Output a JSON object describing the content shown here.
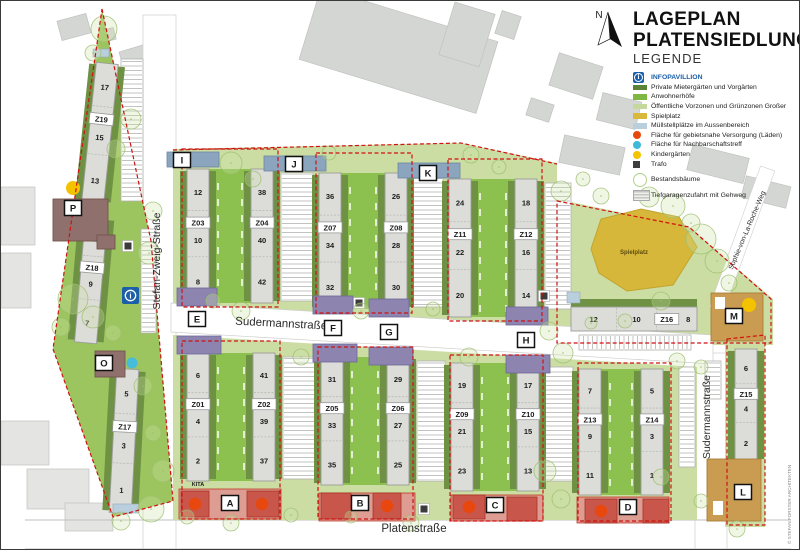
{
  "title": {
    "line1": "LAGEPLAN",
    "line2": "PLATENSIEDLUNG"
  },
  "legend": {
    "heading": "LEGENDE",
    "info_item": {
      "label": "INFOPAVILLION",
      "color": "#1a5fa8"
    },
    "items": [
      {
        "type": "swatch",
        "color": "#5c8236",
        "label": "Private Mietergärten und Vorgärten"
      },
      {
        "type": "swatch",
        "color": "#7eb843",
        "label": "Anwohnerhöfe"
      },
      {
        "type": "swatch",
        "color": "#c4d89c",
        "label": "Öffentliche Vorzonen und Grünzonen Großer"
      },
      {
        "type": "swatch",
        "color": "#d9b93c",
        "label": "Spielplatz"
      },
      {
        "type": "swatch",
        "color": "#b9cfdd",
        "label": "Müllstellplätze im Aussenbereich"
      },
      {
        "type": "circle",
        "color": "#e8470e",
        "label": "Fläche für gebietsnahe Versorgung (Läden)"
      },
      {
        "type": "circle",
        "color": "#3fb9d8",
        "label": "Fläche für Nachbarschaftstreff"
      },
      {
        "type": "circle",
        "color": "#f4c400",
        "label": "Kindergärten"
      },
      {
        "type": "square",
        "color": "#3d3d3d",
        "label": "Trafo"
      },
      {
        "type": "tree",
        "color": "#b7d58e",
        "label": "Bestandsbäume",
        "gap": true
      },
      {
        "type": "ramp",
        "color": "#c9c9c9",
        "label": "Tiefgaragenzufahrt mit Gehweg",
        "gap": true
      }
    ]
  },
  "north": {
    "label": "N"
  },
  "copyright": "© STEFAN FORSTER ARCHITEKTEN",
  "map": {
    "colors": {
      "light_green": "#cbdda2",
      "yard_green": "#8cc04f",
      "dark_green": "#6e9143",
      "triangle_green": "#9cc45f",
      "building": "#dcdcd8",
      "building_stroke": "#9c9e9a",
      "blue_head": "#8ba5bf",
      "purple_head": "#8d85b0",
      "tan": "#c99c52",
      "mauve": "#8f706c",
      "commercial_strip": "#dd9d92",
      "commercial_block": "#c8564a",
      "red": "#d01111",
      "spielplatz": "#d7b739",
      "muell_blue": "#b9cfdd",
      "cyan": "#45bcd9",
      "yellow": "#f3c300",
      "trafo": "#3b3b3b",
      "context": "#d4d6d3",
      "context_light": "#e4e5e3"
    },
    "street_labels": [
      {
        "name": "Stefan-Zweig-Straße",
        "x": 159,
        "y": 260,
        "rotate": -90,
        "size": 10.5
      },
      {
        "name": "Sudermannstraße",
        "x": 280,
        "y": 326,
        "rotate": 3,
        "size": 11.5
      },
      {
        "name": "Sudermannstraße",
        "x": 709,
        "y": 416,
        "rotate": -90,
        "size": 10.5
      },
      {
        "name": "Platenstraße",
        "x": 413,
        "y": 531,
        "rotate": 0,
        "size": 11.5
      },
      {
        "name": "Sophie-von-La-Roche-Weg",
        "x": 748,
        "y": 230,
        "rotate": -67,
        "size": 7
      }
    ],
    "buildings": [
      {
        "z": "Z19",
        "nums": [
          "17",
          "15",
          "13"
        ],
        "x": 88,
        "y": 62,
        "w": 22,
        "h": 140,
        "tilt": 6
      },
      {
        "z": "Z18",
        "nums": [
          "11",
          "9",
          "7"
        ],
        "x": 79,
        "y": 216,
        "w": 22,
        "h": 126,
        "tilt": 5
      },
      {
        "z": "Z17",
        "nums": [
          "5",
          "3",
          "1"
        ],
        "x": 112,
        "y": 368,
        "w": 22,
        "h": 144,
        "tilt": 3
      },
      {
        "z": "Z03",
        "nums": [
          "12",
          "10",
          "8"
        ],
        "x": 186,
        "y": 168,
        "w": 22,
        "h": 134,
        "tilt": 0
      },
      {
        "z": "Z04",
        "nums": [
          "38",
          "40",
          "42"
        ],
        "x": 250,
        "y": 168,
        "w": 22,
        "h": 134,
        "tilt": 0
      },
      {
        "z": "Z07",
        "nums": [
          "36",
          "34",
          "32"
        ],
        "x": 318,
        "y": 172,
        "w": 22,
        "h": 136,
        "tilt": 0
      },
      {
        "z": "Z08",
        "nums": [
          "26",
          "28",
          "30"
        ],
        "x": 384,
        "y": 172,
        "w": 22,
        "h": 136,
        "tilt": 0
      },
      {
        "z": "Z11",
        "nums": [
          "24",
          "22",
          "20"
        ],
        "x": 448,
        "y": 178,
        "w": 22,
        "h": 138,
        "tilt": 0
      },
      {
        "z": "Z12",
        "nums": [
          "18",
          "16",
          "14"
        ],
        "x": 514,
        "y": 178,
        "w": 22,
        "h": 138,
        "tilt": 0
      },
      {
        "z": "Z01",
        "nums": [
          "6",
          "4",
          "2"
        ],
        "x": 186,
        "y": 352,
        "w": 22,
        "h": 128,
        "tilt": 0
      },
      {
        "z": "Z02",
        "nums": [
          "41",
          "39",
          "37"
        ],
        "x": 252,
        "y": 352,
        "w": 22,
        "h": 128,
        "tilt": 0
      },
      {
        "z": "Z05",
        "nums": [
          "31",
          "33",
          "35"
        ],
        "x": 320,
        "y": 356,
        "w": 22,
        "h": 128,
        "tilt": 0
      },
      {
        "z": "Z06",
        "nums": [
          "29",
          "27",
          "25"
        ],
        "x": 386,
        "y": 356,
        "w": 22,
        "h": 128,
        "tilt": 0
      },
      {
        "z": "Z09",
        "nums": [
          "19",
          "21",
          "23"
        ],
        "x": 450,
        "y": 362,
        "w": 22,
        "h": 128,
        "tilt": 0
      },
      {
        "z": "Z10",
        "nums": [
          "17",
          "15",
          "13"
        ],
        "x": 516,
        "y": 362,
        "w": 22,
        "h": 128,
        "tilt": 0
      },
      {
        "z": "Z13",
        "nums": [
          "7",
          "9",
          "11"
        ],
        "x": 578,
        "y": 368,
        "w": 22,
        "h": 126,
        "tilt": 0
      },
      {
        "z": "Z14",
        "nums": [
          "5",
          "3",
          "1"
        ],
        "x": 640,
        "y": 368,
        "w": 22,
        "h": 126,
        "tilt": 0
      },
      {
        "z": "Z15",
        "nums": [
          "6",
          "4",
          "2"
        ],
        "x": 734,
        "y": 348,
        "w": 22,
        "h": 112,
        "tilt": 0
      },
      {
        "z": "Z16",
        "nums": [
          "12",
          "10",
          "8"
        ],
        "x": 570,
        "y": 306,
        "w": 126,
        "h": 24,
        "tilt": 0,
        "horizontal": true
      }
    ],
    "yards": [
      {
        "label": "Hof 2",
        "x": 208,
        "y": 168,
        "w": 42,
        "h": 134,
        "lx": 230,
        "ly": 233
      },
      {
        "label": "Hof 4",
        "x": 340,
        "y": 172,
        "w": 44,
        "h": 136,
        "lx": 362,
        "ly": 238
      },
      {
        "label": "Hof 6",
        "x": 470,
        "y": 178,
        "w": 44,
        "h": 138,
        "lx": 492,
        "ly": 240
      },
      {
        "label": "Hof 1",
        "x": 208,
        "y": 352,
        "w": 44,
        "h": 128,
        "lx": 230,
        "ly": 399
      },
      {
        "label": "Hof 3",
        "x": 342,
        "y": 356,
        "w": 44,
        "h": 128,
        "lx": 364,
        "ly": 402
      },
      {
        "label": "Hof 5",
        "x": 472,
        "y": 362,
        "w": 44,
        "h": 128,
        "lx": 494,
        "ly": 412
      },
      {
        "label": "Hof 7",
        "x": 600,
        "y": 368,
        "w": 40,
        "h": 126,
        "lx": 620,
        "ly": 418
      }
    ],
    "markers": [
      {
        "letter": "A",
        "x": 229,
        "y": 502
      },
      {
        "letter": "B",
        "x": 359,
        "y": 502
      },
      {
        "letter": "C",
        "x": 494,
        "y": 504
      },
      {
        "letter": "D",
        "x": 627,
        "y": 506
      },
      {
        "letter": "E",
        "x": 196,
        "y": 318
      },
      {
        "letter": "F",
        "x": 332,
        "y": 327
      },
      {
        "letter": "G",
        "x": 388,
        "y": 331
      },
      {
        "letter": "H",
        "x": 525,
        "y": 339
      },
      {
        "letter": "I",
        "x": 181,
        "y": 159
      },
      {
        "letter": "J",
        "x": 293,
        "y": 163
      },
      {
        "letter": "K",
        "x": 427,
        "y": 172
      },
      {
        "letter": "L",
        "x": 742,
        "y": 491
      },
      {
        "letter": "M",
        "x": 733,
        "y": 315
      },
      {
        "letter": "O",
        "x": 103,
        "y": 362
      },
      {
        "letter": "P",
        "x": 72,
        "y": 207
      }
    ],
    "kita": {
      "label": "KITA",
      "x": 197,
      "y": 485
    },
    "spielplatz_label": {
      "label": "Spielplatz",
      "x": 633,
      "y": 253
    },
    "context": [
      [
        58,
        16,
        30,
        20,
        -15,
        0
      ],
      [
        100,
        28,
        14,
        12,
        -15,
        0
      ],
      [
        122,
        44,
        44,
        34,
        -17,
        0
      ],
      [
        94,
        96,
        16,
        13,
        -17,
        0
      ],
      [
        305,
        12,
        185,
        75,
        17,
        0
      ],
      [
        445,
        6,
        42,
        55,
        17,
        0
      ],
      [
        497,
        12,
        20,
        24,
        18,
        0
      ],
      [
        552,
        58,
        46,
        34,
        18,
        0
      ],
      [
        527,
        100,
        24,
        18,
        18,
        0
      ],
      [
        598,
        96,
        40,
        28,
        14,
        0
      ],
      [
        560,
        140,
        62,
        28,
        12,
        0
      ],
      [
        688,
        150,
        58,
        26,
        14,
        0
      ],
      [
        742,
        180,
        46,
        22,
        14,
        0
      ],
      [
        0,
        186,
        34,
        58,
        0,
        1
      ],
      [
        0,
        252,
        30,
        55,
        0,
        1
      ],
      [
        0,
        420,
        48,
        44,
        0,
        1
      ],
      [
        26,
        468,
        62,
        40,
        0,
        1
      ],
      [
        64,
        502,
        48,
        28,
        0,
        1
      ],
      [
        736,
        552,
        36,
        12,
        0,
        1
      ]
    ],
    "parking_v": [
      [
        280,
        172,
        32,
        128
      ],
      [
        412,
        176,
        30,
        130
      ],
      [
        544,
        182,
        26,
        126
      ],
      [
        282,
        356,
        32,
        122
      ],
      [
        416,
        360,
        28,
        120
      ],
      [
        544,
        366,
        28,
        114
      ],
      [
        678,
        366,
        16,
        100
      ],
      [
        704,
        360,
        16,
        38
      ],
      [
        140,
        228,
        15,
        104
      ],
      [
        120,
        58,
        22,
        142
      ]
    ],
    "parking_h": [
      [
        578,
        334,
        112,
        15
      ]
    ],
    "blue_heads": [
      [
        166,
        151,
        52,
        15
      ],
      [
        263,
        155,
        62,
        15
      ],
      [
        397,
        162,
        62,
        15
      ]
    ],
    "purple_heads": [
      [
        176,
        287,
        40,
        18
      ],
      [
        176,
        335,
        44,
        18
      ],
      [
        312,
        295,
        40,
        18
      ],
      [
        312,
        343,
        44,
        18
      ],
      [
        368,
        298,
        40,
        18
      ],
      [
        368,
        346,
        44,
        18
      ],
      [
        505,
        306,
        42,
        18
      ],
      [
        505,
        354,
        44,
        18
      ]
    ],
    "tan_buildings": [
      [
        710,
        292,
        52,
        48
      ],
      [
        706,
        458,
        54,
        62
      ]
    ],
    "tan_notches": [
      [
        714,
        296,
        10,
        12
      ],
      [
        712,
        500,
        10,
        14
      ]
    ],
    "mauve_buildings": [
      [
        52,
        198,
        55,
        42
      ],
      [
        96,
        234,
        18,
        14
      ],
      [
        94,
        350,
        30,
        26
      ]
    ],
    "commercial_strips": [
      [
        178,
        488,
        102,
        30
      ],
      [
        318,
        492,
        96,
        28
      ],
      [
        450,
        494,
        92,
        26
      ],
      [
        576,
        496,
        92,
        26
      ]
    ],
    "commercial_blocks": [
      [
        180,
        490,
        28,
        26
      ],
      [
        246,
        490,
        32,
        26
      ],
      [
        320,
        492,
        30,
        26
      ],
      [
        372,
        492,
        28,
        26
      ],
      [
        452,
        494,
        32,
        24
      ],
      [
        506,
        496,
        30,
        24
      ],
      [
        584,
        498,
        32,
        24
      ],
      [
        642,
        498,
        26,
        24
      ]
    ],
    "red_circles": [
      [
        194,
        503
      ],
      [
        261,
        503
      ],
      [
        386,
        505
      ],
      [
        468,
        506
      ],
      [
        600,
        510
      ]
    ],
    "dots": {
      "info": {
        "x": 121,
        "y": 286
      },
      "cyan": [
        [
          131,
          362
        ]
      ],
      "yellow": [
        [
          72,
          187
        ],
        [
          748,
          304
        ]
      ],
      "trafo": [
        [
          127,
          245
        ],
        [
          358,
          302
        ],
        [
          543,
          295
        ],
        [
          423,
          508
        ]
      ],
      "muell": [
        [
          92,
          48,
          16,
          8
        ],
        [
          112,
          503,
          26,
          9
        ],
        [
          566,
          291,
          13,
          11
        ]
      ]
    },
    "trees": [
      [
        103,
        28,
        13
      ],
      [
        92,
        52,
        8
      ],
      [
        130,
        118,
        10
      ],
      [
        115,
        148,
        9
      ],
      [
        152,
        210,
        9
      ],
      [
        148,
        252,
        11
      ],
      [
        72,
        298,
        15
      ],
      [
        92,
        316,
        11
      ],
      [
        112,
        332,
        8
      ],
      [
        60,
        326,
        9
      ],
      [
        142,
        385,
        9
      ],
      [
        152,
        432,
        8
      ],
      [
        162,
        470,
        11
      ],
      [
        150,
        508,
        13
      ],
      [
        120,
        520,
        9
      ],
      [
        186,
        516,
        7
      ],
      [
        230,
        162,
        11
      ],
      [
        252,
        178,
        8
      ],
      [
        212,
        300,
        7
      ],
      [
        240,
        310,
        9
      ],
      [
        328,
        152,
        7
      ],
      [
        360,
        310,
        8
      ],
      [
        300,
        356,
        8
      ],
      [
        470,
        154,
        8
      ],
      [
        498,
        166,
        7
      ],
      [
        432,
        308,
        7
      ],
      [
        468,
        356,
        9
      ],
      [
        560,
        190,
        10
      ],
      [
        582,
        178,
        7
      ],
      [
        600,
        195,
        8
      ],
      [
        648,
        196,
        10
      ],
      [
        672,
        205,
        12
      ],
      [
        700,
        238,
        15
      ],
      [
        716,
        260,
        12
      ],
      [
        690,
        222,
        9
      ],
      [
        728,
        282,
        8
      ],
      [
        660,
        300,
        9
      ],
      [
        624,
        320,
        7
      ],
      [
        590,
        322,
        6
      ],
      [
        548,
        330,
        9
      ],
      [
        562,
        352,
        10
      ],
      [
        544,
        470,
        11
      ],
      [
        560,
        498,
        9
      ],
      [
        660,
        476,
        8
      ],
      [
        700,
        500,
        7
      ],
      [
        736,
        528,
        8
      ],
      [
        410,
        522,
        8
      ],
      [
        350,
        516,
        6
      ],
      [
        290,
        514,
        7
      ],
      [
        230,
        522,
        8
      ],
      [
        676,
        360,
        8
      ],
      [
        700,
        366,
        7
      ]
    ]
  }
}
